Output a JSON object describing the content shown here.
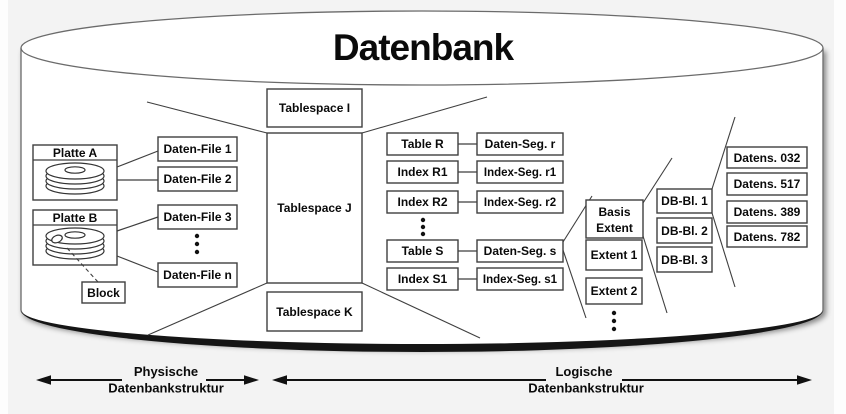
{
  "title": "Datenbank",
  "physical": {
    "disks": [
      {
        "label": "Platte A"
      },
      {
        "label": "Platte B"
      }
    ],
    "block": "Block",
    "files": [
      "Daten-File 1",
      "Daten-File 2",
      "Daten-File 3",
      "Daten-File n"
    ]
  },
  "tablespaces": [
    "Tablespace I",
    "Tablespace J",
    "Tablespace K"
  ],
  "logical": {
    "tables": [
      "Table R",
      "Index R1",
      "Index R2",
      "Table S",
      "Index S1"
    ],
    "segments": [
      "Daten-Seg. r",
      "Index-Seg. r1",
      "Index-Seg. r2",
      "Daten-Seg. s",
      "Index-Seg. s1"
    ],
    "extents": {
      "basis": [
        "Basis",
        "Extent"
      ],
      "items": [
        "Extent 1",
        "Extent 2"
      ]
    },
    "db_blocks": [
      "DB-Bl. 1",
      "DB-Bl. 2",
      "DB-Bl. 3"
    ],
    "records": [
      "Datens. 032",
      "Datens. 517",
      "Datens. 389",
      "Datens. 782"
    ]
  },
  "legend": {
    "physical": [
      "Physische",
      "Datenbankstruktur"
    ],
    "logical": [
      "Logische",
      "Datenbankstruktur"
    ]
  },
  "icons": [
    "disk-stack-icon",
    "block-marker-icon"
  ],
  "colors": {
    "background": "#f3f3f3",
    "cylinder_fill": "#ffffff",
    "box_stroke": "#3f3f3f",
    "text": "#0a0a0a"
  }
}
